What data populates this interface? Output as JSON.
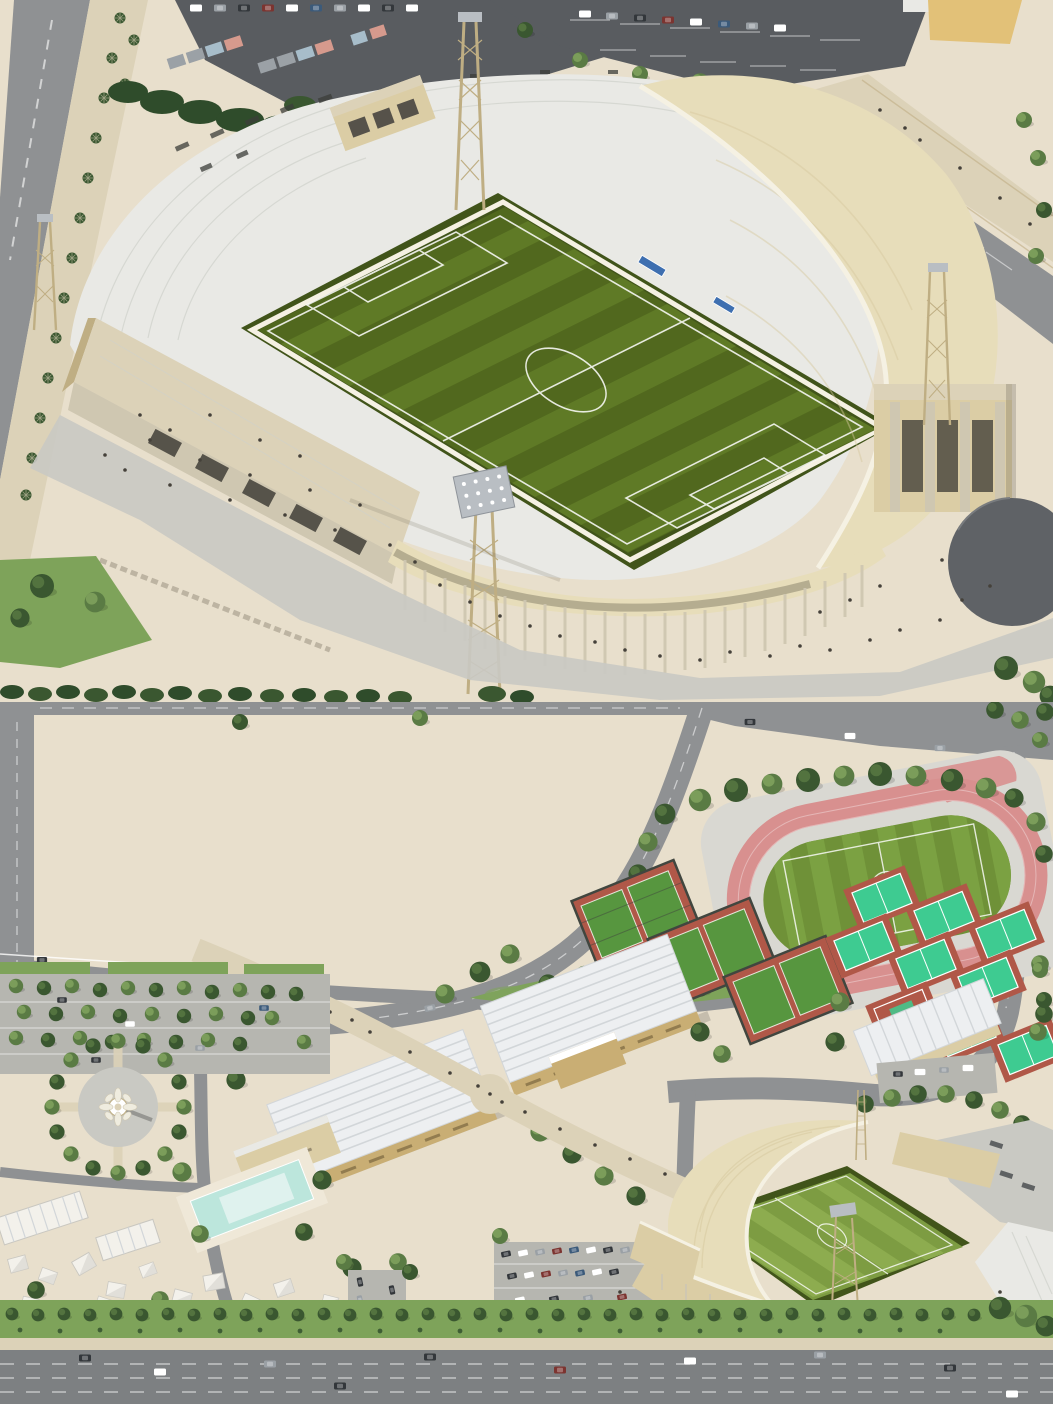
{
  "meta": {
    "title": "Stadium complex aerial renders",
    "width_px": 1053,
    "height_px": 1404,
    "panels": 2
  },
  "scenes": {
    "top": {
      "name": "stadium-closeup-render",
      "description": "Aerial 3D render of a stadium: dark-green striped football pitch, white seating bowl, sweeping cream membrane roof on the right, stone-clad pavilion and colonnade at the lower left, gold lattice floodlight towers, plazas with pedestrians, tree-lined road and container parking lots at top, gray circular pad at right edge",
      "landmarks": [
        "football pitch",
        "seating bowl",
        "cream roof",
        "floodlight towers",
        "stone pavilion",
        "colonnade",
        "container parking",
        "palm-lined road",
        "circular pad"
      ]
    },
    "bottom": {
      "name": "sports-complex-site-render",
      "description": "Aerial 3D render of the full sports complex: pink running track with green infield, caged mini football pitches, teal tennis courts, two large white-ribbed halls with gold walls, diagonal pedestrian promenade, ornamental tower on a circular tree-ringed plaza, tree-filled parking, swimming pool, white tents, the stadium at lower right, and a wide highway along the bottom",
      "landmarks": [
        "running track",
        "mini football cages",
        "tennis courts",
        "exhibition halls",
        "promenade",
        "tower plaza",
        "parking lots",
        "swimming pool",
        "tents",
        "stadium",
        "highway"
      ]
    }
  },
  "colors": {
    "plaza": "#e8dfcc",
    "plaza2": "#efe8d8",
    "walkway": "#dcd2b8",
    "sand": "#e2c178",
    "road": "#8f9193",
    "roadDark": "#7d8082",
    "asphalt": "#595c60",
    "lotGray": "#b6b6b0",
    "concrete": "#c9c9c3",
    "standWhite": "#e9e9e5",
    "standLine": "#cfd1cb",
    "roofCream": "#e7ddba",
    "roofCreamDark": "#d6c89e",
    "rim": "#f5f1e3",
    "beigeWall": "#dbcda5",
    "beigeDark": "#bfae83",
    "stone": "#cfc7b1",
    "goldWall": "#c9ae74",
    "whiteRoof": "#edeff1",
    "whiteRoofLine": "#d2d6d9",
    "pitchDark": "#51681e",
    "pitchStripe": "#5f7a26",
    "pitchLight": "#7d9c42",
    "pitchLightStripe": "#8dac4f",
    "grassEdge": "#41541a",
    "miniGreen": "#57963f",
    "trackPink": "#d8908f",
    "infield": "#6f9138",
    "infieldStripe": "#7ba142",
    "tennisTeal": "#3ecb91",
    "courtRed": "#b05848",
    "cageDark": "#41463f",
    "treeDark": "#3a5730",
    "treeMid": "#5a7b44",
    "treeLight": "#81a35e",
    "hedge": "#2f4c2b",
    "verge": "#7ea35a",
    "pool": "#bce6dc",
    "poolLight": "#e2f3ef",
    "people": "#45413a",
    "white": "#ffffff",
    "carDark": "#33373b",
    "carRed": "#7c3430",
    "carBlue": "#3b5a7a",
    "carGray": "#9aa0a5",
    "containerBlue": "#a7bdca",
    "containerSalmon": "#d69a8d",
    "containerGray": "#9ba1a6",
    "pad": "#5f6266",
    "bench": "#3e6fb0",
    "tentWhite": "#f3f1eb",
    "tentShade": "#d9d7d1",
    "panel": "#b9bec3"
  }
}
